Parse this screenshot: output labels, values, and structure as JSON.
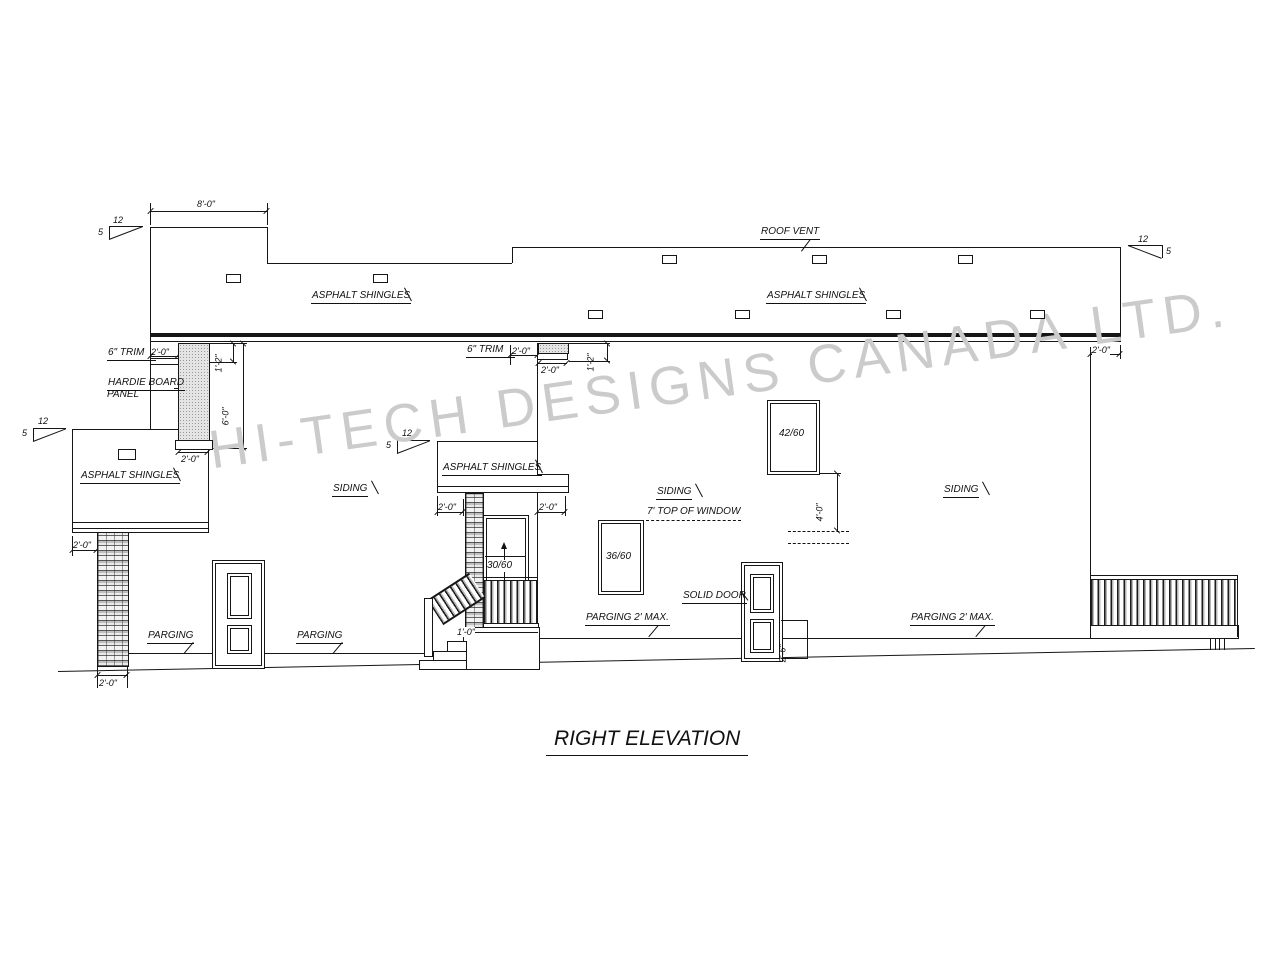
{
  "title": "RIGHT ELEVATION",
  "watermark": "HI-TECH DESIGNS CANADA LTD.",
  "pitch": {
    "run": "12",
    "rise": "5"
  },
  "labels": {
    "roof_vent": "ROOF VENT",
    "asphalt": "ASPHALT SHINGLES",
    "trim": "6\" TRIM",
    "hardie1": "HARDIE BOARD",
    "hardie2": "PANEL",
    "siding": "SIDING",
    "top_of_window": "7' TOP OF WINDOW",
    "solid_door": "SOLID DOOR",
    "parging": "PARGING",
    "parging_max": "PARGING 2' MAX."
  },
  "windows": {
    "w4260": "42/60",
    "w3660": "36/60",
    "w3060": "30/60"
  },
  "dims": {
    "ft8": "8'-0\"",
    "ft2": "2'-0\"",
    "ft1_2": "1'-2\"",
    "ft6": "6'-0\"",
    "ft4": "4'-0\"",
    "ft2_6": "2'-6\"",
    "ft1": "1'-0\""
  },
  "colors": {
    "line": "#161616",
    "watermark": "#cbcbcb",
    "paper": "#ffffff"
  }
}
